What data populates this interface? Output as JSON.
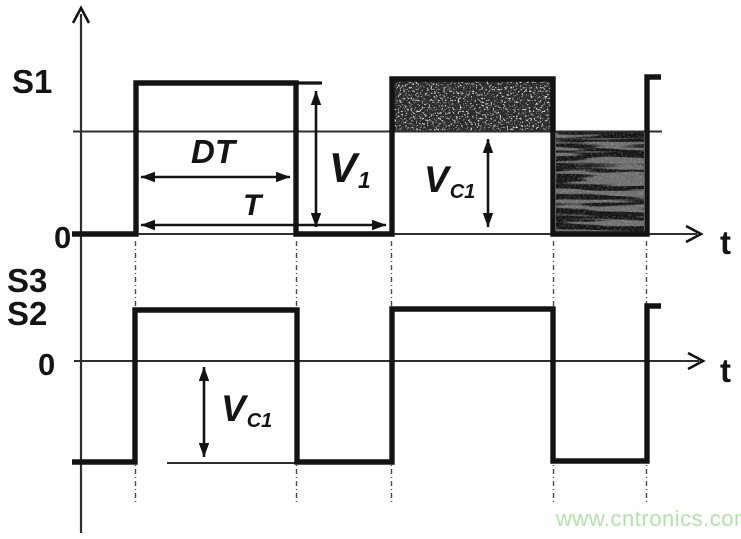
{
  "top_chart": {
    "axis_label_y": "S1",
    "origin_label": "0",
    "axis_label_x": "t",
    "duty_interval_label": "DT",
    "period_label": "T",
    "v1_label": {
      "base": "V",
      "sub": "1"
    },
    "vc1_label": {
      "base": "V",
      "sub": "C1"
    }
  },
  "bottom_chart": {
    "axis_label_y_upper": "S3",
    "axis_label_y_lower": "S2",
    "origin_label": "0",
    "axis_label_x": "t",
    "vc1_label": {
      "base": "V",
      "sub": "C1"
    }
  },
  "watermark": {
    "text": "www.cntronics.com",
    "color": "#b6dfae"
  },
  "colors": {
    "ink": "#131313",
    "thin_line": "#2e2e2e",
    "dash_line": "#4a4a4a",
    "shade_on_area": "#2d2d2d",
    "shade_off_area": "#181818",
    "background": "#ffffff"
  }
}
